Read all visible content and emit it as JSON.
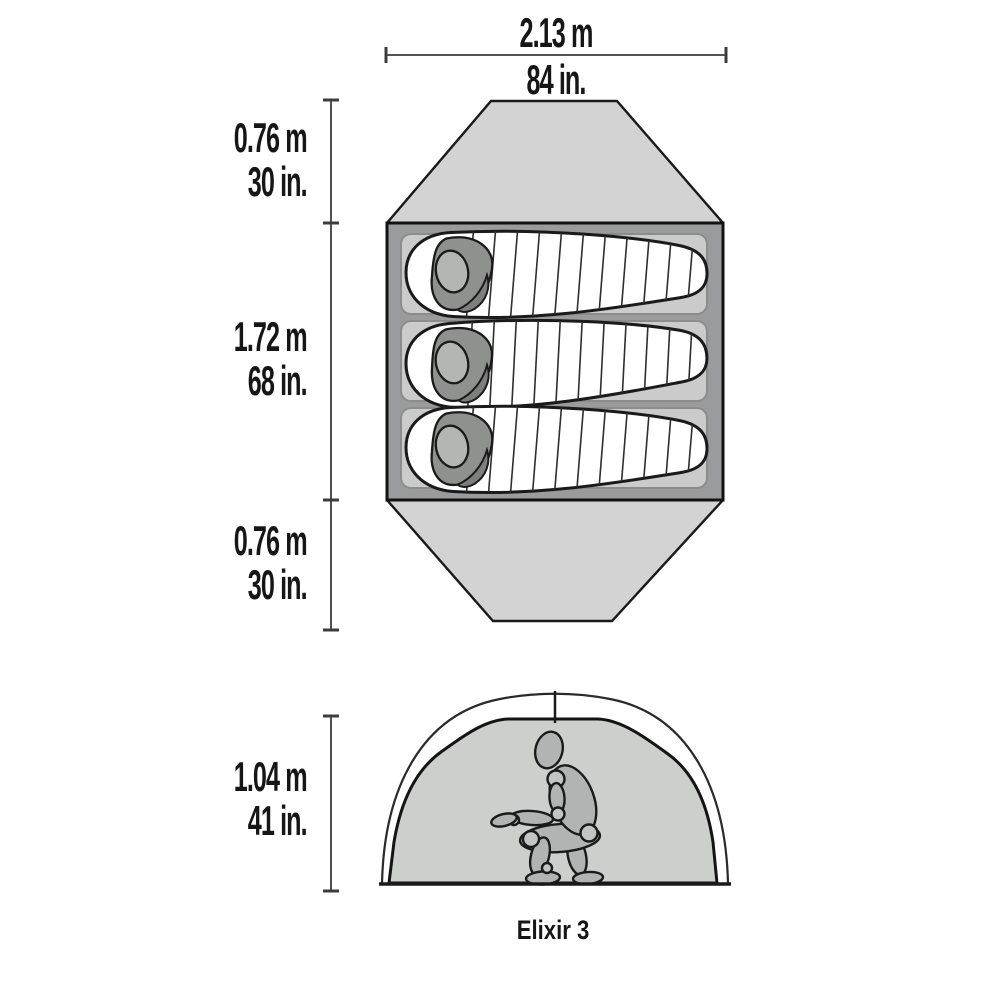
{
  "product": {
    "name": "Elixir 3"
  },
  "top_view": {
    "width": {
      "metric": "2.13 m",
      "imperial": "84 in."
    },
    "top_vestibule_depth": {
      "metric": "0.76 m",
      "imperial": "30 in."
    },
    "interior_length": {
      "metric": "1.72 m",
      "imperial": "68 in."
    },
    "bottom_vestibule_depth": {
      "metric": "0.76 m",
      "imperial": "30 in."
    },
    "sleeping_bag_count": 3
  },
  "cross_section": {
    "peak_height": {
      "metric": "1.04 m",
      "imperial": "41 in."
    }
  },
  "colors": {
    "vestibule_fill": "#d2d3d2",
    "floor_fill": "#9a9b9c",
    "pad_fill": "#cacbca",
    "bag_fill": "#ffffff",
    "hood_fill": "#8f918f",
    "hood_shadow_fill": "#7d7f7d",
    "head_pillow_fill": "#b4b6b4",
    "dome_fill": "#cdcfcd",
    "fly_fill": "#ffffff",
    "figure_fill": "#b2b4b3",
    "outline": "#1a1a1a",
    "dim_line": "#3c3c3c",
    "text": "#161616"
  }
}
